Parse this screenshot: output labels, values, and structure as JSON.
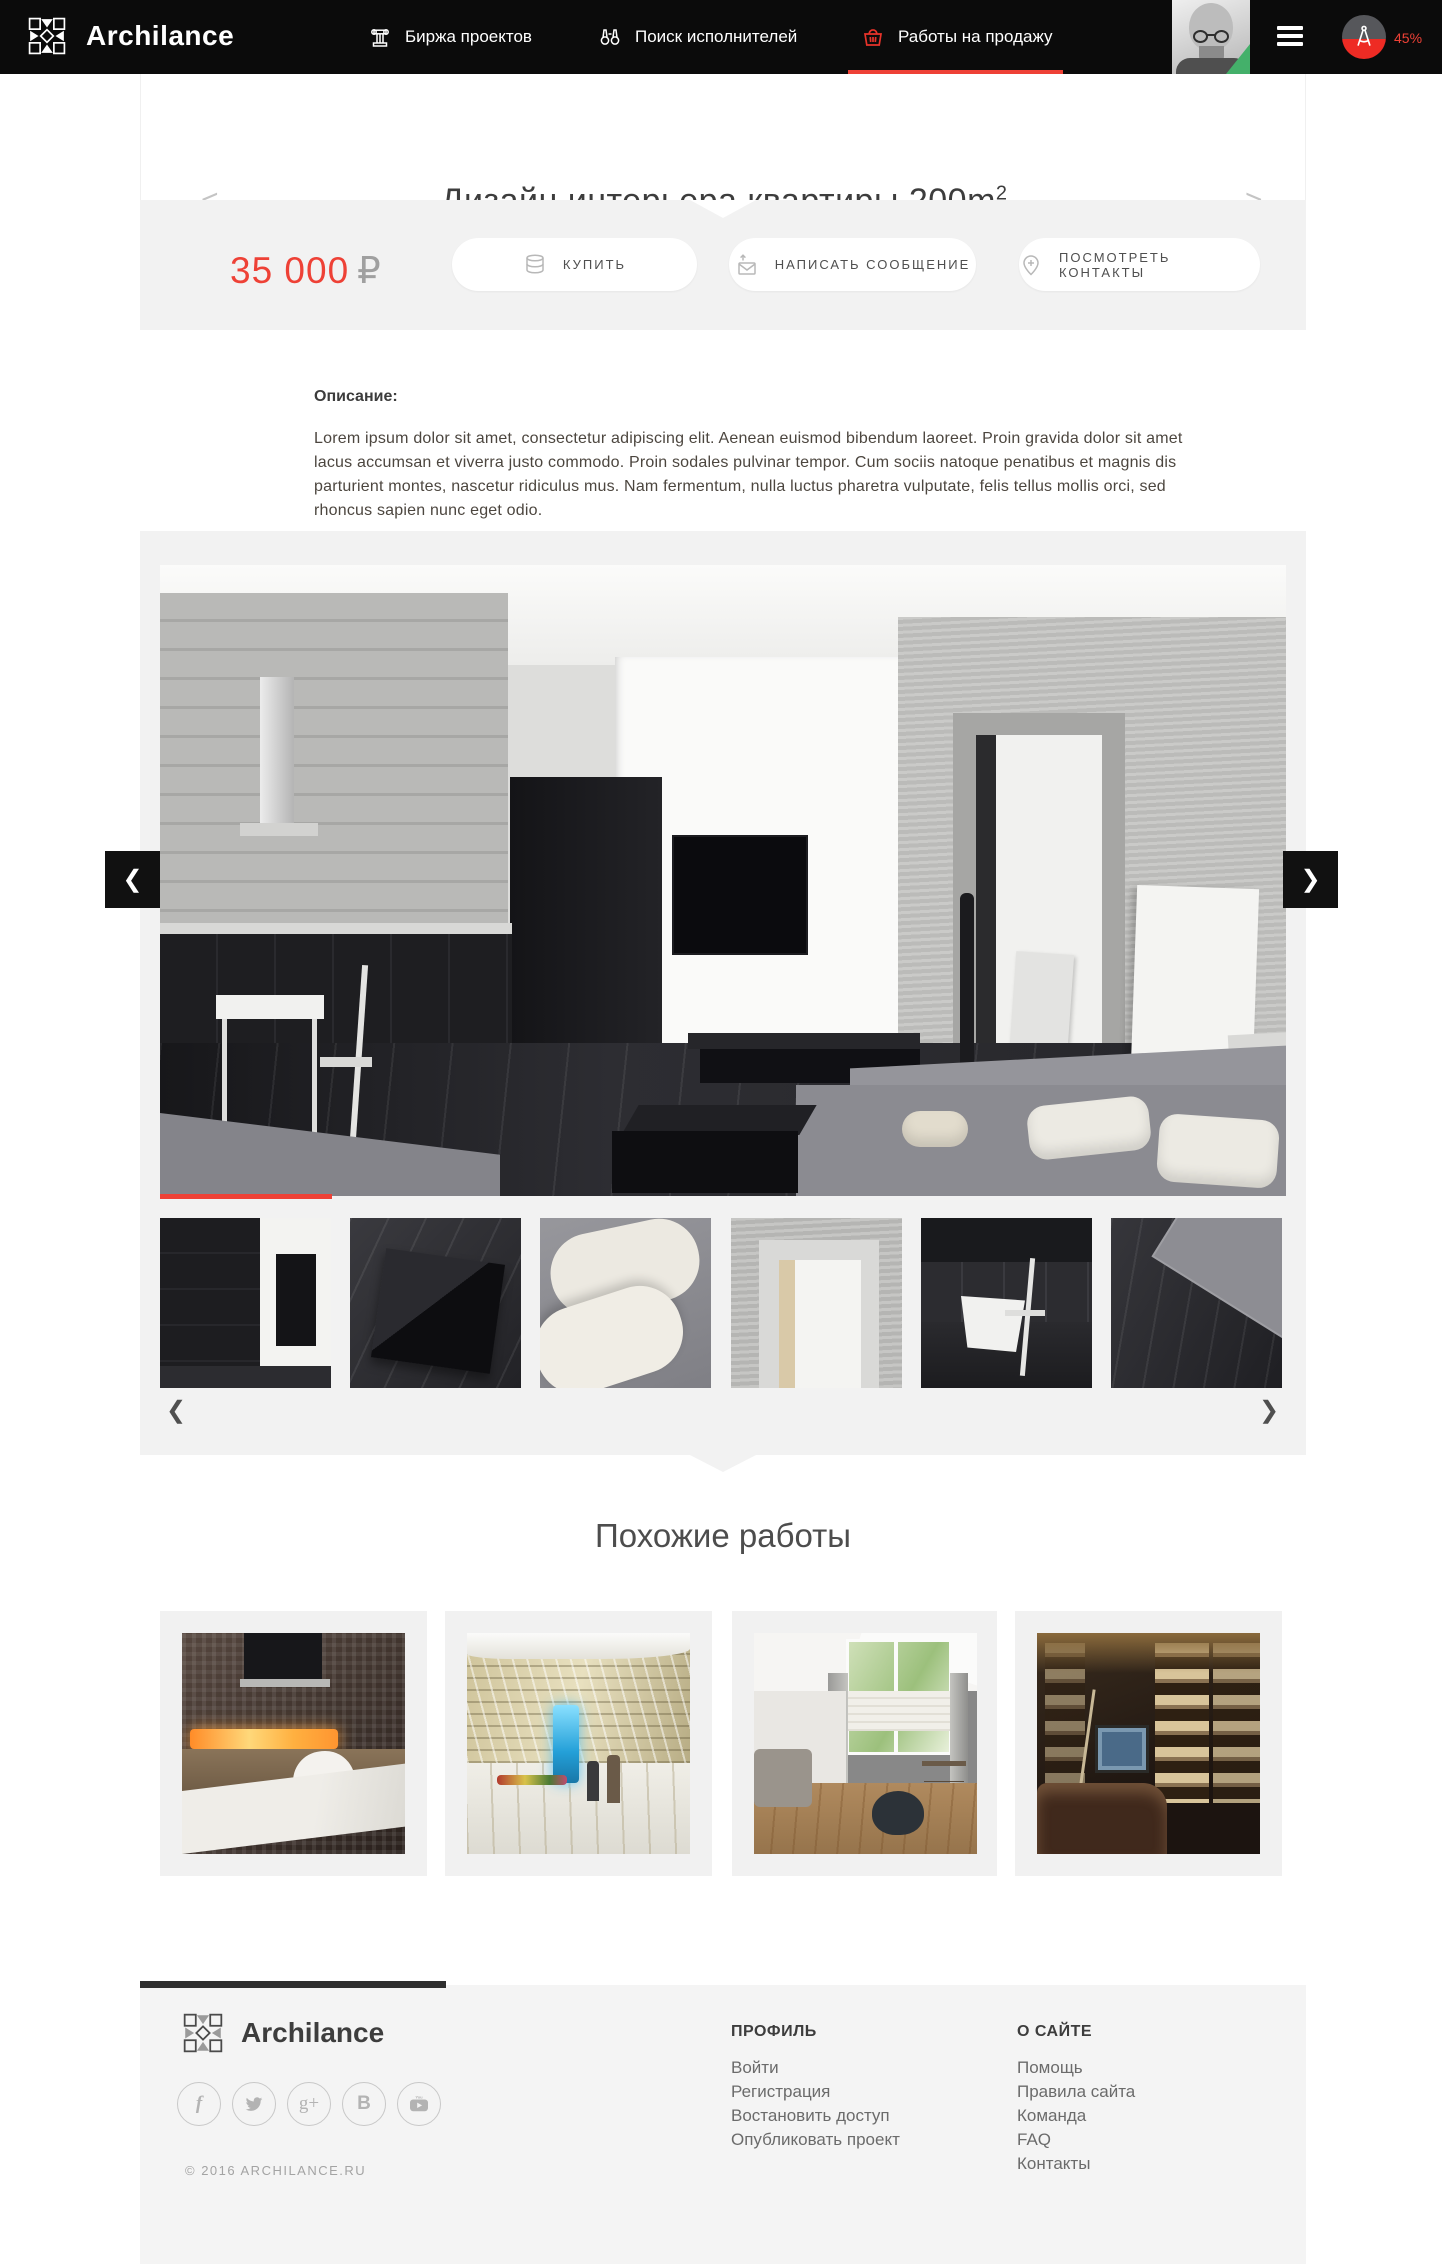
{
  "header": {
    "brand": "Archilance",
    "nav": [
      {
        "label": "Биржа проектов",
        "icon": "bank-column-icon"
      },
      {
        "label": "Поиск исполнителей",
        "icon": "binoculars-icon"
      },
      {
        "label": "Работы на продажу",
        "icon": "basket-icon",
        "active": true
      }
    ],
    "menu_icon": "hamburger-icon",
    "progress_badge": {
      "icon": "drafting-compass-icon",
      "value": "45%"
    }
  },
  "title_bar": {
    "prev_arrow": "<",
    "prev_label": "предыдущий",
    "title": "Дизайн интерьера квартиры 200m",
    "title_sup": "2",
    "next_arrow": ">",
    "next_label": "следующий"
  },
  "purchase": {
    "price": "35 000",
    "currency": "₽",
    "buy_label": "КУПИТЬ",
    "buy_icon": "coins-icon",
    "message_label": "НАПИСАТЬ СООБЩЕНИЕ",
    "message_icon": "envelope-send-icon",
    "contacts_label": "ПОСМОТРЕТЬ КОНТАКТЫ",
    "contacts_icon": "pin-plus-icon"
  },
  "description": {
    "heading": "Описание:",
    "text": "Lorem ipsum dolor sit amet, consectetur adipiscing elit. Aenean euismod bibendum laoreet. Proin gravida dolor sit amet lacus accumsan et viverra justo commodo. Proin sodales pulvinar tempor. Cum sociis natoque penatibus et magnis dis parturient montes, nascetur ridiculus mus. Nam fermentum, nulla luctus pharetra vulputate, felis tellus mollis orci, sed rhoncus sapien nunc eget odio."
  },
  "gallery": {
    "prev_glyph": "❮",
    "next_glyph": "❯",
    "thumb_prev_glyph": "❮",
    "thumb_next_glyph": "❯"
  },
  "similar": {
    "heading": "Похожие работы"
  },
  "footer": {
    "brand": "Archilance",
    "copyright": "© 2016 ARCHILANCE.RU",
    "social": [
      {
        "name": "facebook-icon",
        "glyph": "f"
      },
      {
        "name": "twitter-icon",
        "glyph": "t"
      },
      {
        "name": "google-plus-icon",
        "glyph": "g+"
      },
      {
        "name": "vk-icon",
        "glyph": "B"
      },
      {
        "name": "youtube-icon",
        "glyph": "▶"
      }
    ],
    "columns": [
      {
        "heading": "ПРОФИЛЬ",
        "links": [
          "Войти",
          "Регистрация",
          "Востановить доступ",
          "Опубликовать проект"
        ]
      },
      {
        "heading": "О САЙТЕ",
        "links": [
          "Помощь",
          "Правила сайта",
          "Команда",
          "FAQ",
          "Контакты"
        ]
      }
    ]
  },
  "colors": {
    "accent": "#ee4136",
    "header_bg": "#0b0b0b",
    "section_bg": "#f2f2f2",
    "footer_bg": "#f4f4f4"
  }
}
